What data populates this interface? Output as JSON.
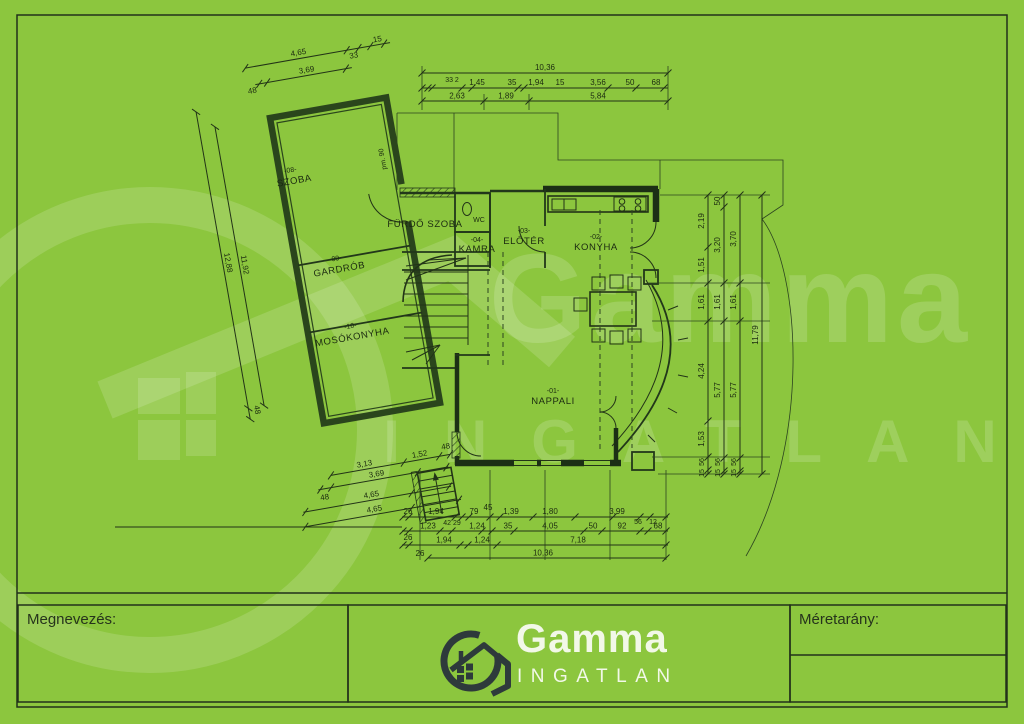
{
  "colors": {
    "background": "#8cc63e",
    "plan_line": "#1c2f15",
    "old_wall": "#2a451c",
    "logo_dark": "#2e3a3b",
    "logo_text": "#f2f8e8",
    "watermark": "rgba(255,255,255,0.15)"
  },
  "brand": {
    "name": "Gamma",
    "subtitle": "INGATLAN"
  },
  "title_block": {
    "name_label": "Megnevezés:",
    "scale_label": "Méretarány:"
  },
  "rooms": {
    "szoba": {
      "id": "-08-",
      "name": "SZOBA"
    },
    "furdoszoba": {
      "name": "FÜRDŐ SZOBA"
    },
    "wc": {
      "name": "WC"
    },
    "kamra": {
      "id": "-04-",
      "name": "KAMRA"
    },
    "eloter": {
      "id": "-03-",
      "name": "ELŐTÉR"
    },
    "konyha": {
      "id": "-02-",
      "name": "KONYHA"
    },
    "gardrob": {
      "id": "-09-",
      "name": "GARDRÓB"
    },
    "mosokonyha": {
      "id": "-10-",
      "name": "MOSÓKONYHA"
    },
    "nappali": {
      "id": "-01-",
      "name": "NAPPALI"
    }
  },
  "notes": {
    "door": "pm. 90"
  },
  "dims": {
    "top_left": {
      "total": "4,65",
      "seg33": "33",
      "seg15": "15",
      "row2": "3,69",
      "left48": "48"
    },
    "top": {
      "total": "10,36",
      "mini": "33 2",
      "r2": [
        "1,45",
        "35",
        "1,94",
        "15",
        "3,56",
        "50",
        "68"
      ],
      "r3": [
        "2,63",
        "1,89",
        "5,84"
      ]
    },
    "left": {
      "inner": "11,92",
      "outer": "12,88",
      "end48": "48"
    },
    "right": {
      "c1": [
        "2,19",
        "1,51",
        "1,61",
        "4,24",
        "1,53",
        "56",
        "15"
      ],
      "c2": [
        "50",
        "3,20",
        "1,61",
        "5,77",
        "56",
        "15"
      ],
      "c3": [
        "3,70",
        "1,61",
        "5,77",
        "56",
        "15"
      ],
      "total": "11,79"
    },
    "bottom_left": {
      "l1a": "3,13",
      "l1b": "1,52",
      "l1c": "48",
      "l2a": "48",
      "l2b": "3,69",
      "l3": "4,65",
      "l4": "4,65"
    },
    "bottom": {
      "rA": [
        "26",
        "1,94",
        "79",
        "1,39",
        "1,80",
        "3,99",
        "56",
        "12"
      ],
      "above": "45",
      "below": "42 29",
      "rB": [
        "26",
        "1,23",
        "1,24",
        "35",
        "4,05",
        "50",
        "92",
        "68"
      ],
      "rC": [
        "26",
        "1,94",
        "1,24",
        "7,18"
      ],
      "total": "10,36"
    }
  }
}
